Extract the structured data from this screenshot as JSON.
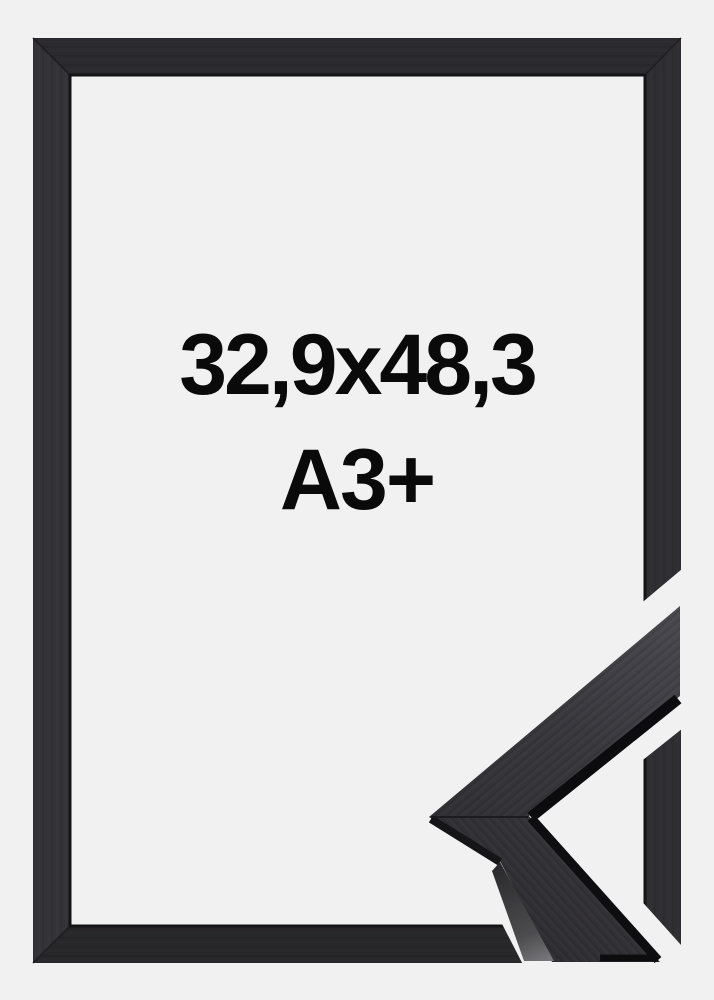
{
  "product_image": {
    "kind": "picture-frame-product-photo",
    "labels": {
      "size": "32,9x48,3",
      "format": "A3+"
    },
    "colors": {
      "background": "#f1f1f2",
      "frame_wood": "#2c2b2f",
      "frame_wood_light": "#3a393e",
      "moulding_side_face": "#0c0c0e",
      "label_text": "#0a0a0b"
    }
  }
}
